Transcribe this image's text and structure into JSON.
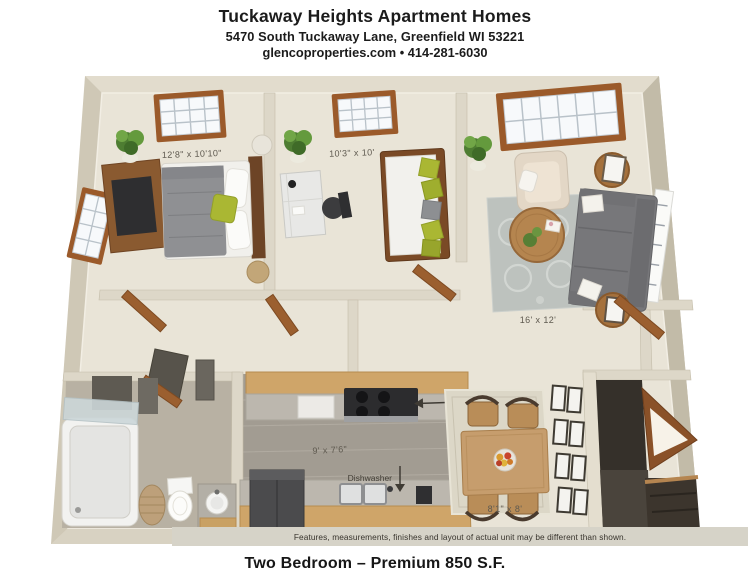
{
  "header": {
    "title": "Tuckaway Heights Apartment Homes",
    "address": "5470 South Tuckaway Lane, Greenfield WI 53221",
    "contact": "glencoproperties.com • 414-281-6030"
  },
  "floorplan": {
    "master_bedroom": {
      "dims": "12'8\" x 10'10\""
    },
    "bedroom2": {
      "dims": "10'3\" x 10'"
    },
    "living_room": {
      "dims": "16' x 12'"
    },
    "kitchen": {
      "dims": "9' x 7'6\"",
      "microwave_label": "Microwave",
      "dishwasher_label": "Dishwasher"
    },
    "dining": {
      "dims": "8'1\" x 8'"
    },
    "disclaimer": "Features, measurements, finishes and layout of actual unit may be different than shown."
  },
  "footer": {
    "plan_name": "Two Bedroom – Premium 850 S.F."
  },
  "colors": {
    "wall": "#cfc8b6",
    "floor": "#e9e4d7",
    "kitchen_floor": "#a29c92",
    "wood_trim": "#9b5a2a",
    "cabinet_tan": "#cfa569",
    "accent_green": "#aab733",
    "sofa_gray": "#77777a",
    "rug_gray": "#bdc2be"
  }
}
